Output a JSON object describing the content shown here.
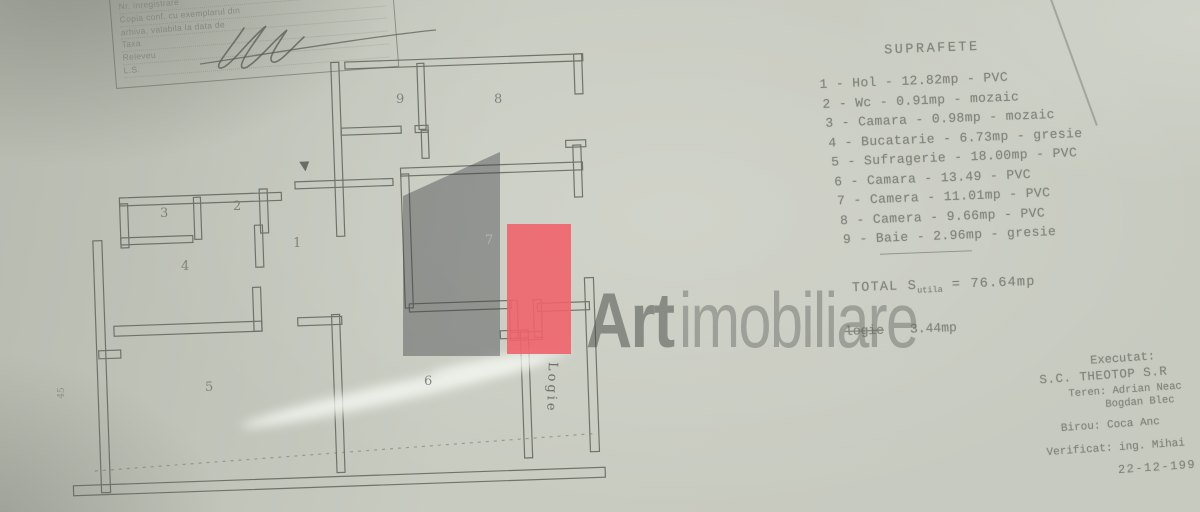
{
  "stamp": {
    "lines": [
      "Nr. inregistrare",
      "Copia conf. cu exemplarul din",
      "arhiva, valabila la data de",
      "Taxa",
      "Releveu",
      "L.S."
    ]
  },
  "surfaces": {
    "title": "SUPRAFETE",
    "sep": " - ",
    "items": [
      {
        "num": "1",
        "name": "Hol",
        "area": "12.82mp",
        "finish": "PVC"
      },
      {
        "num": "2",
        "name": "Wc",
        "area": "0.91mp",
        "finish": "mozaic"
      },
      {
        "num": "3",
        "name": "Camara",
        "area": "0.98mp",
        "finish": "mozaic"
      },
      {
        "num": "4",
        "name": "Bucatarie",
        "area": "6.73mp",
        "finish": "gresie"
      },
      {
        "num": "5",
        "name": "Sufragerie",
        "area": "18.00mp",
        "finish": "PVC"
      },
      {
        "num": "6",
        "name": "Camara",
        "area": "13.49",
        "finish": "PVC"
      },
      {
        "num": "7",
        "name": "Camera",
        "area": "11.01mp",
        "finish": "PVC"
      },
      {
        "num": "8",
        "name": "Camera",
        "area": "9.66mp",
        "finish": "PVC"
      },
      {
        "num": "9",
        "name": "Baie",
        "area": "2.96mp",
        "finish": "gresie"
      }
    ],
    "total_label": "TOTAL S",
    "total_sub": "utila",
    "total_eq": " = ",
    "total_value": "76.64mp",
    "logie_label": "logie",
    "logie_value": "3.44mp"
  },
  "watermark": {
    "brand_bold": "Art",
    "brand_light": "imobiliare",
    "red_color": "#ee646c",
    "grey_color": "#5c5e62"
  },
  "plan": {
    "labels": {
      "r1": "1",
      "r2": "2",
      "r3": "3",
      "r4": "4",
      "r5": "5",
      "r6": "6",
      "r7": "7",
      "r8": "8",
      "r9": "9"
    },
    "logia": "Logie",
    "dim": "45"
  },
  "credits": {
    "lines": [
      "Executat:",
      "S.C. THEOTOP S.R",
      "Teren: Adrian Neac",
      "Bogdan Blec",
      "Birou: Coca Anc",
      "Verificat: ing. Mihai",
      "22-12-199"
    ]
  }
}
